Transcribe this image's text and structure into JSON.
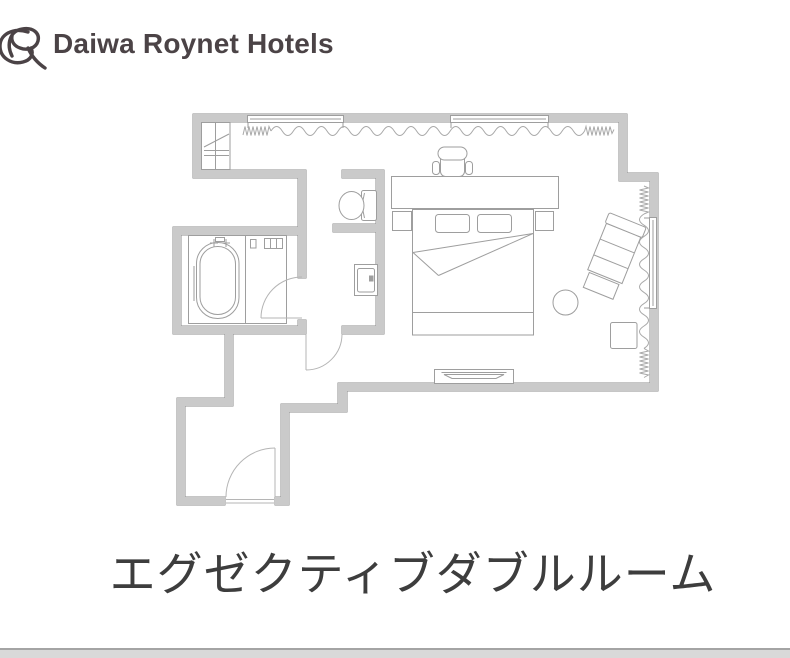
{
  "header": {
    "brand": "Daiwa Roynet Hotels"
  },
  "plan": {
    "title": "エグゼクティブダブルルーム"
  },
  "colors": {
    "logo_color": "#4b4346",
    "title_color": "#3d3d3d",
    "wall_fill": "#cacaca",
    "wall_stroke": "#8e8e8e",
    "furniture": "#9e9e9e",
    "window": "#9e9e9e",
    "door": "#b5b5b5",
    "curtain": "#a9a9a9",
    "footer_bar": "#d9d9d9",
    "footer_line": "#a4a4a4"
  }
}
